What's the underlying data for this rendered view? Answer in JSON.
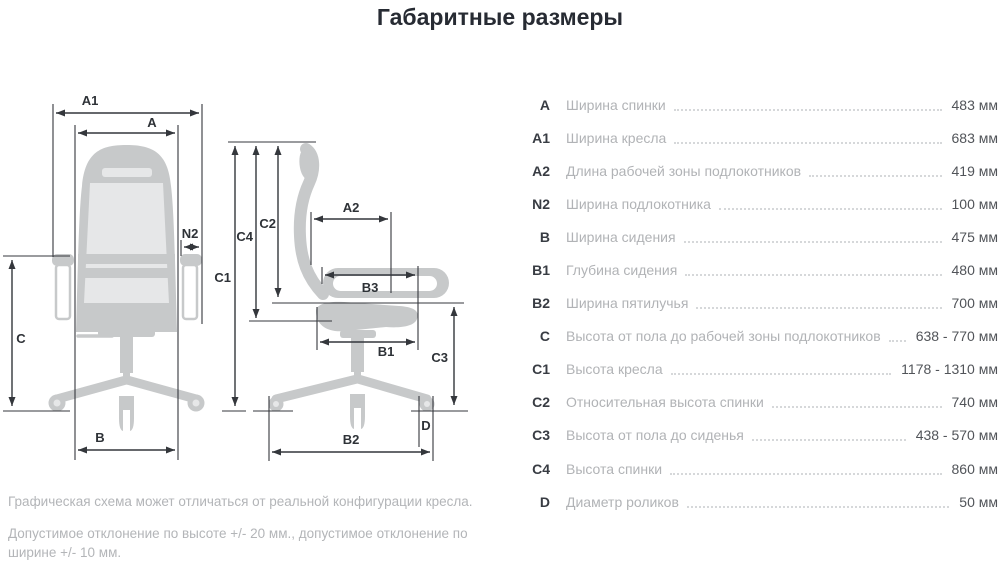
{
  "title": "Габаритные размеры",
  "colors": {
    "chair_silhouette": "#c7c9ca",
    "chair_inner": "#e6e7e8",
    "dimension_lines": "#34373c",
    "table_code_text": "#383c43",
    "table_label_text": "#b1b3b6",
    "table_value_text": "#515459",
    "background": "#ffffff"
  },
  "diagram": {
    "labels": {
      "a": "A",
      "a1": "A1",
      "a2": "A2",
      "n2": "N2",
      "b": "B",
      "b1": "B1",
      "b2": "B2",
      "b3": "B3",
      "c": "C",
      "c1": "C1",
      "c2": "C2",
      "c3": "C3",
      "c4": "C4",
      "d": "D"
    }
  },
  "table": {
    "rows": [
      {
        "code": "A",
        "label": "Ширина спинки",
        "value": "483 мм"
      },
      {
        "code": "A1",
        "label": "Ширина кресла",
        "value": "683 мм"
      },
      {
        "code": "A2",
        "label": "Длина рабочей зоны подлокотников",
        "value": "419 мм"
      },
      {
        "code": "N2",
        "label": "Ширина подлокотника",
        "value": "100 мм"
      },
      {
        "code": "B",
        "label": "Ширина сидения",
        "value": "475 мм"
      },
      {
        "code": "B1",
        "label": "Глубина сидения",
        "value": "480 мм"
      },
      {
        "code": "B2",
        "label": "Ширина пятилучья",
        "value": "700 мм"
      },
      {
        "code": "C",
        "label": "Высота от пола до рабочей зоны подлокотников",
        "value": "638 - 770 мм"
      },
      {
        "code": "C1",
        "label": "Высота кресла",
        "value": "1178 - 1310 мм"
      },
      {
        "code": "C2",
        "label": "Относительная высота спинки",
        "value": "740 мм"
      },
      {
        "code": "C3",
        "label": "Высота от пола до сиденья",
        "value": "438 - 570 мм"
      },
      {
        "code": "C4",
        "label": "Высота спинки",
        "value": "860 мм"
      },
      {
        "code": "D",
        "label": "Диаметр роликов",
        "value": "50 мм"
      }
    ]
  },
  "notes": [
    "Графическая схема может отличаться от реальной конфигурации кресла.",
    "Допустимое отклонение по высоте +/- 20 мм., допустимое отклонение по ширине +/- 10 мм."
  ]
}
